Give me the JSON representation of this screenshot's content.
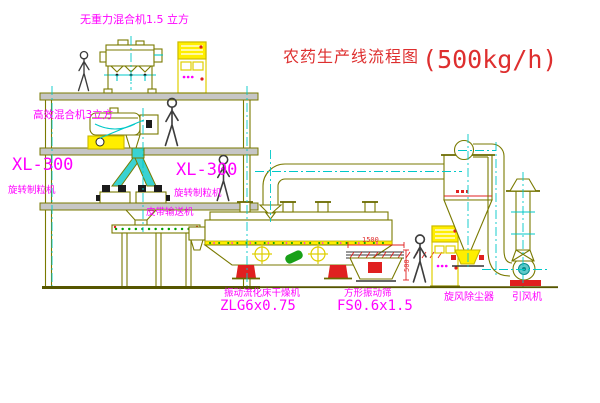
{
  "title": {
    "text": "农药生产线流程图",
    "capacity": "(500kg/h)"
  },
  "labels": {
    "zero_gravity_mixer": "无重力混合机1.5 立方",
    "high_eff_mixer": "高效混合机3立方",
    "granulator_model_left": "XL-300",
    "granulator_left": "旋转制粒机",
    "granulator_model_mid": "XL-300",
    "granulator_mid": "旋转制粒机",
    "belt_conveyor": "皮带输送机",
    "dryer": "振动流化床干燥机",
    "dryer_model": "ZLG6x0.75",
    "sieve": "方形振动筛",
    "sieve_model": "FS0.6x1.5",
    "cyclone": "旋风除尘器",
    "fan": "引风机"
  },
  "dimensions": {
    "sieve_length": "1500",
    "sieve_height": "500"
  },
  "palette": {
    "cad_line": "#7a7a00",
    "centerline_cyan": "#00c8c8",
    "cabinet_yellow": "#ffee00",
    "label_magenta": "#ff00ff",
    "alarm_red": "#e02020",
    "motor_green": "#18a018",
    "title_red": "#de2f2f",
    "background": "#ffffff"
  }
}
